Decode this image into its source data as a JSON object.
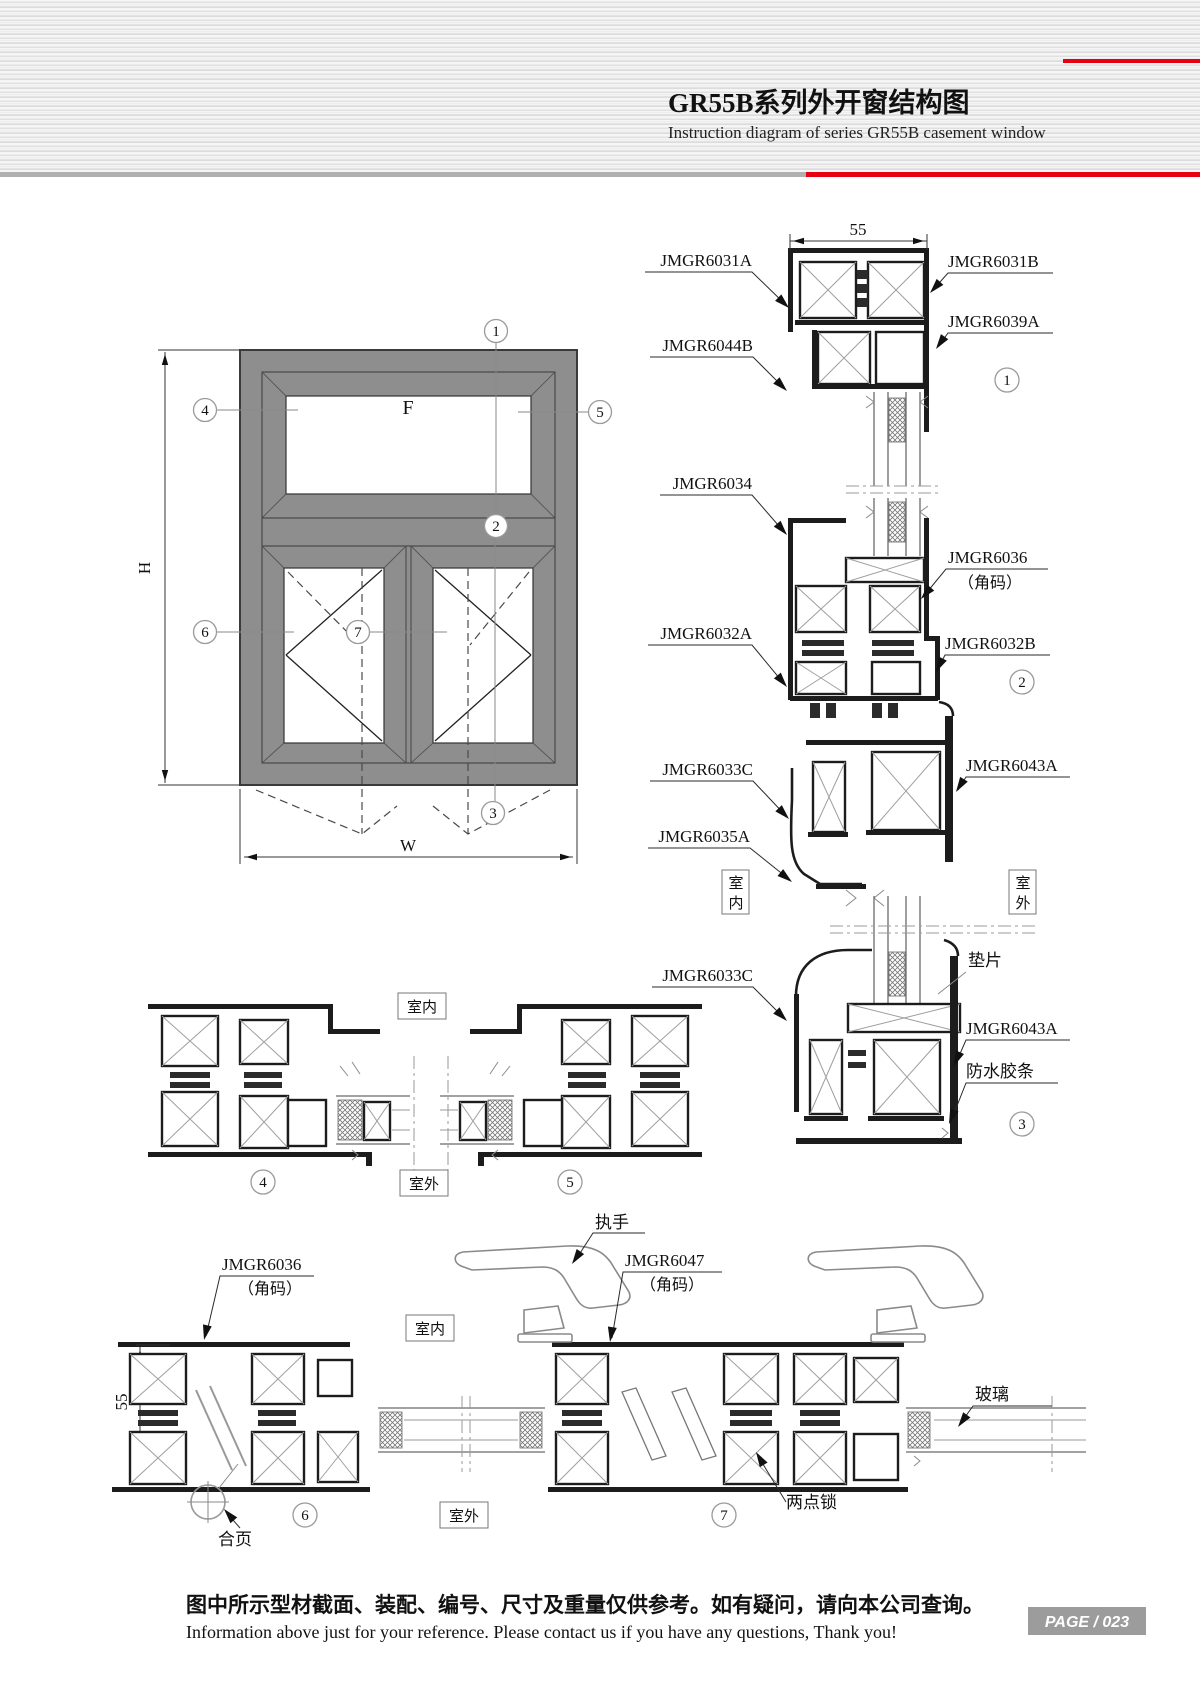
{
  "header": {
    "title": "GR55B系列外开窗结构图",
    "subtitle": "Instruction diagram of series GR55B casement window"
  },
  "elevation": {
    "pane_label": "F",
    "dim_h": "H",
    "dim_w": "W",
    "callout_1": "1",
    "callout_2": "2",
    "callout_3": "3",
    "callout_4": "4",
    "callout_5": "5",
    "callout_6": "6",
    "callout_7": "7"
  },
  "detail_1": {
    "dim_top": "55",
    "part_top_left": "JMGR6031A",
    "part_mid_left": "JMGR6044B",
    "part_top_right": "JMGR6031B",
    "part_mid_right": "JMGR6039A",
    "num": "1"
  },
  "detail_2": {
    "part_left_top": "JMGR6034",
    "part_left_bottom": "JMGR6032A",
    "part_right_top": "JMGR6036",
    "part_right_top_sub": "（角码）",
    "part_right_bottom": "JMGR6032B",
    "num": "2"
  },
  "detail_3": {
    "part_left_top": "JMGR6033C",
    "part_left_mid": "JMGR6035A",
    "part_right_top": "JMGR6043A",
    "indoor_char_1": "室",
    "indoor_char_2": "内",
    "outdoor_char_1": "室",
    "outdoor_char_2": "外",
    "part_left_lower": "JMGR6033C",
    "shim": "垫片",
    "part_right_lower": "JMGR6043A",
    "strip": "防水胶条",
    "num": "3"
  },
  "sections_45": {
    "indoor": "室内",
    "outdoor": "室外",
    "num_4": "4",
    "num_5": "5"
  },
  "sections_67": {
    "dim_left": "55",
    "corner_left": "JMGR6036",
    "corner_left_sub": "（角码）",
    "handle": "执手",
    "corner_mid": "JMGR6047",
    "corner_mid_sub": "（角码）",
    "indoor": "室内",
    "outdoor": "室外",
    "glass": "玻璃",
    "lock": "两点锁",
    "hinge": "合页",
    "num_6": "6",
    "num_7": "7"
  },
  "footer": {
    "note_cn": "图中所示型材截面、装配、编号、尺寸及重量仅供参考。如有疑问，请向本公司查询。",
    "note_en": "Information above just for your reference. Please contact us if you have any questions, Thank you!",
    "page": "PAGE / 023"
  }
}
